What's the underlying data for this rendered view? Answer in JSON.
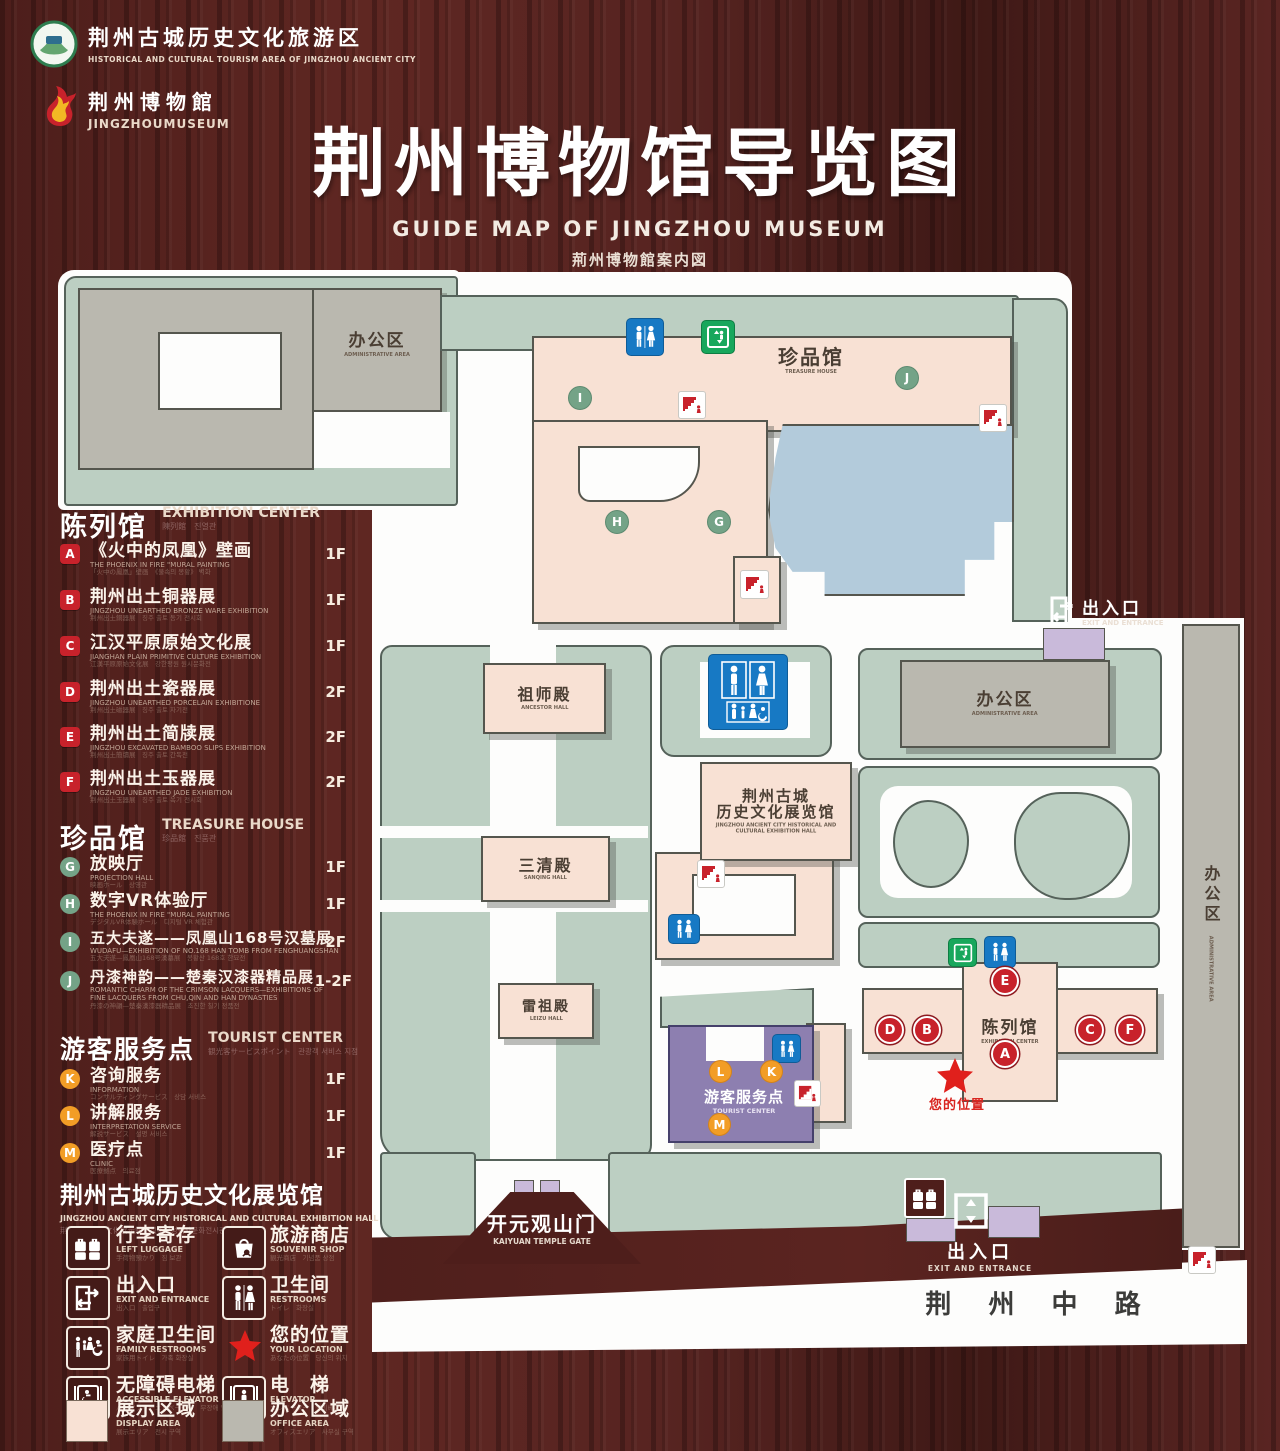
{
  "header": {
    "tourism_logo": {
      "zh": "荆州古城历史文化旅游区",
      "en": "HISTORICAL AND CULTURAL TOURISM AREA OF JINGZHOU ANCIENT CITY"
    },
    "museum_logo": {
      "zh": "荆州博物館",
      "en": "JINGZHOUMUSEUM"
    },
    "title": "荆州博物馆导览图",
    "subtitle_en": "GUIDE MAP OF JINGZHOU MUSEUM",
    "subtitle_ja": "荊州博物館案内図",
    "subtitle_ko": "징주박물관 안내도"
  },
  "legend": {
    "sections": [
      {
        "title": "陈列馆",
        "title_en": "EXHIBITION CENTER",
        "title_sub": "陳列館　진열관",
        "items": [
          {
            "letter": "A",
            "zh": "《火中的凤凰》壁画",
            "en": "THE PHOENIX IN FIRE \"MURAL PAINTING",
            "sub": "「火中の鳳凰」壁画　《불속의 봉황》 벽화",
            "floor": "1F"
          },
          {
            "letter": "B",
            "zh": "荆州出土铜器展",
            "en": "JINGZHOU UNEARTHED BRONZE WARE EXHIBITION",
            "sub": "荆州出土銅器展　징주 출토 동기 전시회",
            "floor": "1F"
          },
          {
            "letter": "C",
            "zh": "江汉平原原始文化展",
            "en": "JIANGHAN PLAIN PRIMITIVE CULTURE EXHIBITION",
            "sub": "江漢平原原始文化展　강한평원 원시문화전",
            "floor": "1F"
          },
          {
            "letter": "D",
            "zh": "荆州出土瓷器展",
            "en": "JINGZHOU UNEARTHED PORCELAIN EXHIBITIONE",
            "sub": "荆州出土磁器展　징주 출토 자기전",
            "floor": "2F"
          },
          {
            "letter": "E",
            "zh": "荆州出土简牍展",
            "en": "JINGZHOU EXCAVATED BAMBOO SLIPS EXHIBITION",
            "sub": "荆州出土簡牘展　징주 출토 간독전",
            "floor": "2F"
          },
          {
            "letter": "F",
            "zh": "荆州出土玉器展",
            "en": "JINGZHOU UNEARTHED JADE EXHIBITION",
            "sub": "荆州出土玉器展　징주 출토 옥기 전시회",
            "floor": "2F"
          }
        ]
      },
      {
        "title": "珍品馆",
        "title_en": "TREASURE HOUSE",
        "title_sub": "珍品館　진품관",
        "items": [
          {
            "letter": "G",
            "zh": "放映厅",
            "en": "PROJECTION HALL",
            "sub": "映画ホール　상영관",
            "floor": "1F"
          },
          {
            "letter": "H",
            "zh": "数字VR体验厅",
            "en": "THE PHOENIX IN FIRE \"MURAL PAINTING",
            "sub": "デジタルVR体験ホール　디지털 VR 체험관",
            "floor": "1F"
          },
          {
            "letter": "I",
            "zh": "五大夫遂——凤凰山168号汉墓展",
            "en": "WUDAFU—EXHIBITION OF NO.168 HAN TOMB FROM FENGHUANGSHAN",
            "sub": "五大夫遂—鳳凰山168号漢墓展　봉황산 168호 한묘전",
            "floor": "2F"
          },
          {
            "letter": "J",
            "zh": "丹漆神韵——楚秦汉漆器精品展",
            "en": "ROMANTIC CHARM OF THE CRIMSON LACQUERS—EXHIBITIONS OF FINE LACQUERS FROM CHU,QIN AND HAN DYNASTIES",
            "sub": "丹漆の神韻—楚秦漢漆器精品展　초진한 칠기 정품전",
            "floor": "1-2F"
          }
        ]
      },
      {
        "title": "游客服务点",
        "title_en": "TOURIST CENTER",
        "title_sub": "観光客サービスポイント　관광객 서비스 지점",
        "items": [
          {
            "letter": "K",
            "zh": "咨询服务",
            "en": "INFORMATION",
            "sub": "コンサルティングサービス　상담 서비스",
            "floor": "1F"
          },
          {
            "letter": "L",
            "zh": "讲解服务",
            "en": "INTERPRETATION SERVICE",
            "sub": "解説サービス　설명 서비스",
            "floor": "1F"
          },
          {
            "letter": "M",
            "zh": "医疗点",
            "en": "CLINIC",
            "sub": "医療拠点　의료점",
            "floor": "1F"
          }
        ]
      }
    ],
    "hall_note": {
      "zh": "荆州古城历史文化展览馆",
      "en": "JINGZHOU ANCIENT CITY HISTORICAL AND CULTURAL EXHIBITION HALL",
      "sub": "荆州古城歴史文化展示館　징주고성역사문화전시관"
    },
    "icons": [
      {
        "id": "left-luggage",
        "zh": "行李寄存",
        "en": "LEFT LUGGAGE",
        "sub": "手荷物預かり　짐 보관"
      },
      {
        "id": "souvenir-shop",
        "zh": "旅游商店",
        "en": "SOUVENIR SHOP",
        "sub": "観光商店　기념품 상점"
      },
      {
        "id": "exit-entrance",
        "zh": "出入口",
        "en": "EXIT AND ENTRANCE",
        "sub": "出入口　출입구"
      },
      {
        "id": "restrooms",
        "zh": "卫生间",
        "en": "RESTROOMS",
        "sub": "トイレ　화장실"
      },
      {
        "id": "family-restrooms",
        "zh": "家庭卫生间",
        "en": "FAMILY RESTROOMS",
        "sub": "家族用トイレ　가족 화장실"
      },
      {
        "id": "your-location",
        "zh": "您的位置",
        "en": "YOUR LOCATION",
        "sub": "あなたの位置　당신의 위치"
      },
      {
        "id": "accessible-elevator",
        "zh": "无障碍电梯",
        "en": "ACCESSIBLE ELEVATOR",
        "sub": "バリアフリーエレベーター　무장애 엘리베이터"
      },
      {
        "id": "elevator",
        "zh": "电　梯",
        "en": "ELEVATOR",
        "sub": "エレベーター　엘리베이터"
      },
      {
        "id": "display-area",
        "zh": "展示区域",
        "en": "DISPLAY AREA",
        "sub": "展示エリア　전시 구역"
      },
      {
        "id": "office-area",
        "zh": "办公区域",
        "en": "OFFICE AREA",
        "sub": "オフィスエリア　사무실 구역"
      }
    ]
  },
  "map": {
    "buildings": {
      "admin_top": {
        "zh": "办公区",
        "en": "ADMINISTRATIVE AREA"
      },
      "treasure": {
        "zh": "珍品馆",
        "en": "TREASURE HOUSE"
      },
      "ancestor": {
        "zh": "祖师殿",
        "en": "ANCESTOR HALL"
      },
      "sanqing": {
        "zh": "三清殿",
        "en": "SANQING HALL"
      },
      "leizu": {
        "zh": "雷祖殿",
        "en": "LEIZU HALL"
      },
      "exhibition_hall": {
        "zh1": "荆州古城",
        "zh2": "历史文化展览馆",
        "en": "JINGZHOU ANCIENT CITY HISTORICAL AND CULTURAL EXHIBITION HALL"
      },
      "admin_right": {
        "zh": "办公区",
        "en": "ADMINISTRATIVE AREA"
      },
      "admin_strip": {
        "zh": "办公区",
        "en": "ADMINISTRATIVE AREA"
      },
      "exhibition_center": {
        "zh": "陈列馆",
        "en": "EXHIBITION CENTER"
      },
      "tourist_center": {
        "zh": "游客服务点",
        "en": "TOURIST CENTER"
      },
      "kaiyuan_gate": {
        "zh": "开元观山门",
        "en": "KAIYUAN TEMPLE GATE"
      },
      "exit_right": {
        "zh": "出入口",
        "en": "EXIT AND ENTRANCE"
      },
      "exit_bottom": {
        "zh": "出入口",
        "en": "EXIT AND ENTRANCE"
      }
    },
    "your_location": "您的位置",
    "road": "荆 州 中 路",
    "markers": {
      "a": "A",
      "b": "B",
      "c": "C",
      "d": "D",
      "e": "E",
      "f": "F",
      "g": "G",
      "h": "H",
      "i": "I",
      "j": "J",
      "k": "K",
      "l": "L",
      "m": "M"
    }
  },
  "colors": {
    "display_area": "#f8e1d4",
    "office_area": "#bab8af",
    "lawn_green": "#bccfc2",
    "pond_blue": "#b3cbdb",
    "tourist_purple": "#8d7fb0",
    "gate_purple": "#c9bada",
    "marker_red": "#c8222b",
    "marker_green": "#74a387",
    "marker_orange": "#f29d26",
    "restroom_blue": "#1779c4",
    "elevator_green": "#18a75c",
    "star_red": "#e0201c"
  }
}
